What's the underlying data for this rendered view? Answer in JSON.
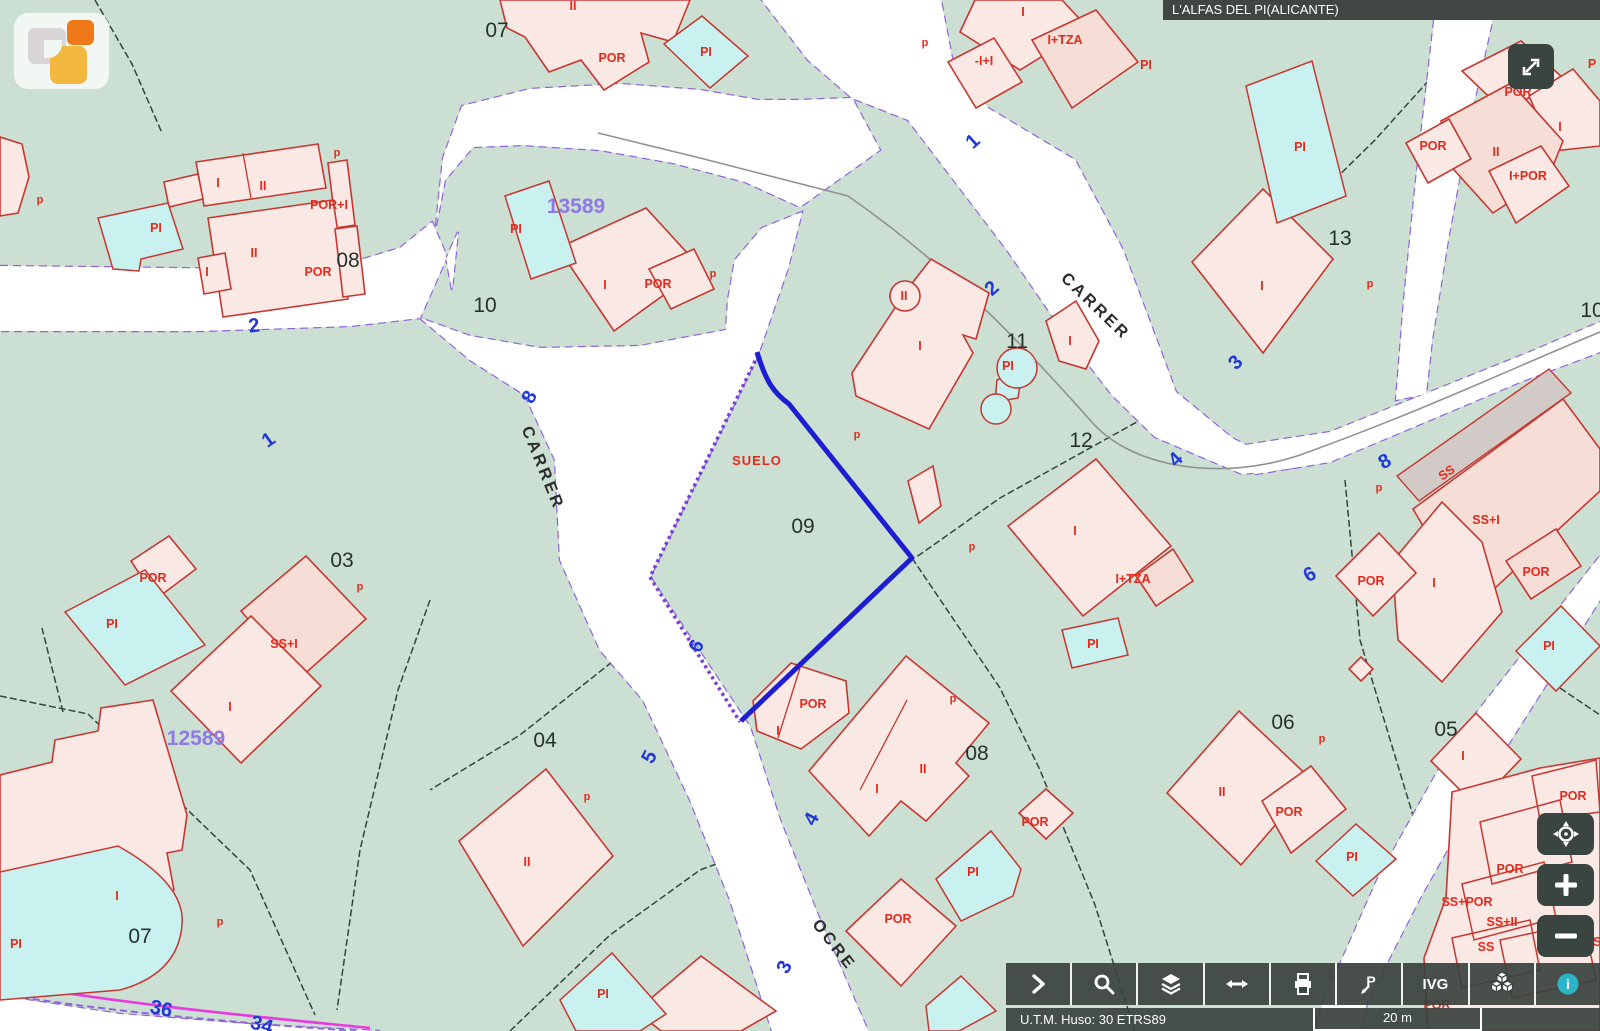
{
  "window": {
    "title": "L'ALFAS DEL PI(ALICANTE)"
  },
  "logo": {
    "icon": "catastro-logo"
  },
  "fullscreen_button": {
    "icon": "expand-arrows-icon"
  },
  "zoom_controls": {
    "buttons": [
      {
        "id": "recenter",
        "icon": "target-icon"
      },
      {
        "id": "zoom-in",
        "icon": "plus-icon",
        "label": "+"
      },
      {
        "id": "zoom-out",
        "icon": "minus-icon",
        "label": "−"
      }
    ]
  },
  "toolbar": {
    "buttons": [
      {
        "id": "expand-tools",
        "icon": "chevron-right-icon"
      },
      {
        "id": "search",
        "icon": "magnifier-icon"
      },
      {
        "id": "layers",
        "icon": "layers-icon"
      },
      {
        "id": "measure",
        "icon": "horizontal-arrows-icon"
      },
      {
        "id": "print",
        "icon": "printer-icon"
      },
      {
        "id": "street-pin",
        "icon": "pin-p-icon"
      },
      {
        "id": "ivg",
        "label": "IVG"
      },
      {
        "id": "buildings-3d",
        "icon": "cubes-icon"
      },
      {
        "id": "info",
        "icon": "info-icon"
      }
    ],
    "ivg_label": "IVG"
  },
  "status_bar": {
    "utm": "U.T.M. Huso: 30 ETRS89",
    "scale": "20 m"
  },
  "map": {
    "selection": {
      "parcel": "09",
      "status": "SUELO"
    },
    "colors": {
      "background": "#ccdfd3",
      "road": "#ffffff",
      "road_border": "#9262dd",
      "building_fill": "#f9e8e3",
      "building_outline": "#c63732",
      "pool_fill": "#c9f1ef",
      "selection_blue": "#1d1ed2",
      "hatch_purple": "#7a3fd8",
      "label_red": "#e42a1d",
      "label_blue": "#2038d4",
      "label_black": "#25332c",
      "label_purple": "#8e79e6",
      "boundary_magenta": "#e93ae0"
    },
    "labels": [
      {
        "t": "POR",
        "x": 612,
        "y": 62,
        "c": "lr"
      },
      {
        "t": "PI",
        "x": 706,
        "y": 56,
        "c": "lr"
      },
      {
        "t": "II",
        "x": 573,
        "y": 10,
        "c": "lr"
      },
      {
        "t": "I",
        "x": 1023,
        "y": 16,
        "c": "lr"
      },
      {
        "t": "-I+I",
        "x": 984,
        "y": 65,
        "c": "lr"
      },
      {
        "t": "I+TZA",
        "x": 1065,
        "y": 44,
        "c": "lr"
      },
      {
        "t": "PI",
        "x": 1146,
        "y": 69,
        "c": "lr"
      },
      {
        "t": "I",
        "x": 218,
        "y": 187,
        "c": "lr"
      },
      {
        "t": "II",
        "x": 263,
        "y": 190,
        "c": "lr"
      },
      {
        "t": "POR+I",
        "x": 329,
        "y": 209,
        "c": "lr"
      },
      {
        "t": "II",
        "x": 254,
        "y": 257,
        "c": "lr"
      },
      {
        "t": "POR",
        "x": 318,
        "y": 276,
        "c": "lr"
      },
      {
        "t": "I",
        "x": 207,
        "y": 276,
        "c": "lr"
      },
      {
        "t": "PI",
        "x": 156,
        "y": 232,
        "c": "lr"
      },
      {
        "t": "PI",
        "x": 516,
        "y": 233,
        "c": "lr"
      },
      {
        "t": "I",
        "x": 605,
        "y": 289,
        "c": "lr"
      },
      {
        "t": "POR",
        "x": 658,
        "y": 288,
        "c": "lr"
      },
      {
        "t": "SUELO",
        "x": 757,
        "y": 465,
        "c": "lsu"
      },
      {
        "t": "II",
        "x": 904,
        "y": 300,
        "c": "lr"
      },
      {
        "t": "I",
        "x": 920,
        "y": 350,
        "c": "lr"
      },
      {
        "t": "I",
        "x": 1070,
        "y": 345,
        "c": "lr"
      },
      {
        "t": "PI",
        "x": 1008,
        "y": 370,
        "c": "lr"
      },
      {
        "t": "PI",
        "x": 1300,
        "y": 151,
        "c": "lr"
      },
      {
        "t": "POR",
        "x": 1433,
        "y": 150,
        "c": "lr"
      },
      {
        "t": "II",
        "x": 1496,
        "y": 156,
        "c": "lr"
      },
      {
        "t": "I",
        "x": 1560,
        "y": 131,
        "c": "lr"
      },
      {
        "t": "POR",
        "x": 1518,
        "y": 96,
        "c": "lr"
      },
      {
        "t": "I+POR",
        "x": 1528,
        "y": 180,
        "c": "lr"
      },
      {
        "t": "P",
        "x": 1592,
        "y": 68,
        "c": "lr"
      },
      {
        "t": "I",
        "x": 1262,
        "y": 290,
        "c": "lr"
      },
      {
        "t": "I",
        "x": 1075,
        "y": 535,
        "c": "lr"
      },
      {
        "t": "I+TZA",
        "x": 1133,
        "y": 583,
        "c": "lr"
      },
      {
        "t": "PI",
        "x": 1093,
        "y": 648,
        "c": "lr"
      },
      {
        "t": "SS",
        "x": 1449,
        "y": 476,
        "c": "lr",
        "rot": -35
      },
      {
        "t": "SS+I",
        "x": 1486,
        "y": 524,
        "c": "lr"
      },
      {
        "t": "POR",
        "x": 1371,
        "y": 585,
        "c": "lr"
      },
      {
        "t": "I",
        "x": 1434,
        "y": 587,
        "c": "lr"
      },
      {
        "t": "POR",
        "x": 1536,
        "y": 576,
        "c": "lr"
      },
      {
        "t": "PI",
        "x": 1549,
        "y": 650,
        "c": "lr"
      },
      {
        "t": "POR",
        "x": 153,
        "y": 582,
        "c": "lr"
      },
      {
        "t": "PI",
        "x": 112,
        "y": 628,
        "c": "lr"
      },
      {
        "t": "SS+I",
        "x": 284,
        "y": 648,
        "c": "lr"
      },
      {
        "t": "I",
        "x": 230,
        "y": 711,
        "c": "lr"
      },
      {
        "t": "II",
        "x": 527,
        "y": 866,
        "c": "lr"
      },
      {
        "t": "POR",
        "x": 813,
        "y": 708,
        "c": "lr"
      },
      {
        "t": "I",
        "x": 778,
        "y": 735,
        "c": "lr"
      },
      {
        "t": "I",
        "x": 877,
        "y": 793,
        "c": "lr"
      },
      {
        "t": "II",
        "x": 923,
        "y": 773,
        "c": "lr"
      },
      {
        "t": "POR",
        "x": 1035,
        "y": 826,
        "c": "lr"
      },
      {
        "t": "PI",
        "x": 973,
        "y": 876,
        "c": "lr"
      },
      {
        "t": "POR",
        "x": 898,
        "y": 923,
        "c": "lr"
      },
      {
        "t": "PI",
        "x": 603,
        "y": 998,
        "c": "lr"
      },
      {
        "t": "I",
        "x": 117,
        "y": 900,
        "c": "lr"
      },
      {
        "t": "PI",
        "x": 16,
        "y": 948,
        "c": "lr"
      },
      {
        "t": "II",
        "x": 1222,
        "y": 796,
        "c": "lr"
      },
      {
        "t": "POR",
        "x": 1289,
        "y": 816,
        "c": "lr"
      },
      {
        "t": "PI",
        "x": 1352,
        "y": 861,
        "c": "lr"
      },
      {
        "t": "I",
        "x": 1463,
        "y": 760,
        "c": "lr"
      },
      {
        "t": "POR",
        "x": 1573,
        "y": 800,
        "c": "lr"
      },
      {
        "t": "POR",
        "x": 1510,
        "y": 873,
        "c": "lr"
      },
      {
        "t": "SS+POR",
        "x": 1467,
        "y": 906,
        "c": "lr"
      },
      {
        "t": "SS+II",
        "x": 1502,
        "y": 926,
        "c": "lr"
      },
      {
        "t": "SS",
        "x": 1486,
        "y": 951,
        "c": "lr"
      },
      {
        "t": "SS",
        "x": 1593,
        "y": 946,
        "c": "lr"
      },
      {
        "t": "POR",
        "x": 1437,
        "y": 1009,
        "c": "lr"
      },
      {
        "t": "p",
        "x": 925,
        "y": 46,
        "c": "lrs"
      },
      {
        "t": "p",
        "x": 337,
        "y": 156,
        "c": "lrs"
      },
      {
        "t": "p",
        "x": 40,
        "y": 203,
        "c": "lrs"
      },
      {
        "t": "p",
        "x": 713,
        "y": 277,
        "c": "lrs"
      },
      {
        "t": "p",
        "x": 857,
        "y": 438,
        "c": "lrs"
      },
      {
        "t": "p",
        "x": 1370,
        "y": 287,
        "c": "lrs"
      },
      {
        "t": "p",
        "x": 972,
        "y": 550,
        "c": "lrs"
      },
      {
        "t": "p",
        "x": 1379,
        "y": 491,
        "c": "lrs"
      },
      {
        "t": "p",
        "x": 360,
        "y": 590,
        "c": "lrs"
      },
      {
        "t": "p",
        "x": 587,
        "y": 800,
        "c": "lrs"
      },
      {
        "t": "p",
        "x": 953,
        "y": 702,
        "c": "lrs"
      },
      {
        "t": "p",
        "x": 220,
        "y": 925,
        "c": "lrs"
      },
      {
        "t": "p",
        "x": 1322,
        "y": 742,
        "c": "lrs"
      },
      {
        "t": "07",
        "x": 497,
        "y": 37,
        "c": "lk"
      },
      {
        "t": "08",
        "x": 348,
        "y": 267,
        "c": "lk"
      },
      {
        "t": "10",
        "x": 485,
        "y": 312,
        "c": "lk"
      },
      {
        "t": "13",
        "x": 1340,
        "y": 245,
        "c": "lk"
      },
      {
        "t": "11",
        "x": 1017,
        "y": 348,
        "c": "lk"
      },
      {
        "t": "12",
        "x": 1081,
        "y": 447,
        "c": "lk"
      },
      {
        "t": "09",
        "x": 803,
        "y": 533,
        "c": "lk"
      },
      {
        "t": "03",
        "x": 342,
        "y": 567,
        "c": "lk"
      },
      {
        "t": "04",
        "x": 545,
        "y": 747,
        "c": "lk"
      },
      {
        "t": "08",
        "x": 977,
        "y": 760,
        "c": "lk"
      },
      {
        "t": "06",
        "x": 1283,
        "y": 729,
        "c": "lk"
      },
      {
        "t": "05",
        "x": 1446,
        "y": 736,
        "c": "lk"
      },
      {
        "t": "07",
        "x": 140,
        "y": 943,
        "c": "lk"
      },
      {
        "t": "10",
        "x": 1592,
        "y": 317,
        "c": "lk"
      },
      {
        "t": "2",
        "x": 255,
        "y": 332,
        "c": "lb",
        "rot": -8
      },
      {
        "t": "1",
        "x": 272,
        "y": 445,
        "c": "lb",
        "rot": -35
      },
      {
        "t": "8",
        "x": 535,
        "y": 400,
        "c": "lb",
        "rot": -62
      },
      {
        "t": "6",
        "x": 702,
        "y": 649,
        "c": "lb",
        "rot": -62
      },
      {
        "t": "5",
        "x": 655,
        "y": 760,
        "c": "lb",
        "rot": -62
      },
      {
        "t": "4",
        "x": 817,
        "y": 822,
        "c": "lb",
        "rot": -62
      },
      {
        "t": "3",
        "x": 790,
        "y": 970,
        "c": "lb",
        "rot": -62
      },
      {
        "t": "1",
        "x": 977,
        "y": 146,
        "c": "lb",
        "rot": -42
      },
      {
        "t": "2",
        "x": 996,
        "y": 293,
        "c": "lb",
        "rot": -42
      },
      {
        "t": "3",
        "x": 1240,
        "y": 367,
        "c": "lb",
        "rot": -45
      },
      {
        "t": "4",
        "x": 1180,
        "y": 464,
        "c": "lb",
        "rot": -45
      },
      {
        "t": "8",
        "x": 1388,
        "y": 467,
        "c": "lb",
        "rot": -30
      },
      {
        "t": "6",
        "x": 1313,
        "y": 580,
        "c": "lb",
        "rot": -30
      },
      {
        "t": "36",
        "x": 160,
        "y": 1015,
        "c": "lb",
        "rot": 12
      },
      {
        "t": "34",
        "x": 260,
        "y": 1031,
        "c": "lb",
        "rot": 16
      },
      {
        "t": "13589",
        "x": 576,
        "y": 213,
        "c": "lv"
      },
      {
        "t": "12589",
        "x": 196,
        "y": 745,
        "c": "lv"
      },
      {
        "t": "CARRER",
        "x": 538,
        "y": 470,
        "c": "ls",
        "rot": 68
      },
      {
        "t": "CARRER",
        "x": 1092,
        "y": 310,
        "c": "ls",
        "rot": 44
      },
      {
        "t": "OCRE",
        "x": 830,
        "y": 948,
        "c": "ls",
        "rot": 52
      }
    ]
  }
}
